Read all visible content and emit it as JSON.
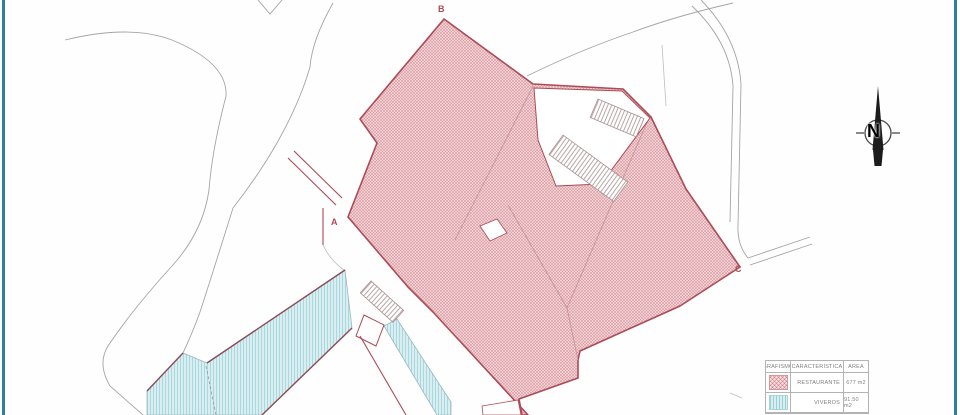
{
  "labels": {
    "point_a": "A",
    "point_b": "B",
    "point_c": "C"
  },
  "compass": {
    "north_label": "N"
  },
  "legend": {
    "headers": [
      "GRAFISMO",
      "CARACTERISTICA",
      "AREA"
    ],
    "rows": [
      {
        "swatch": "red-crosshatch",
        "caracteristica": "RESTAURANTE",
        "area": "677 m2"
      },
      {
        "swatch": "blue-stripes",
        "caracteristica": "VIVEROS",
        "area": "91.50 m2"
      }
    ]
  },
  "colors": {
    "frame": "#2e7e9e",
    "parcel_red": "#ad4a55",
    "hatch_red_bg": "#f5dde0",
    "hatch_red_line": "#d9959d",
    "subdiv_red": "#c58f96",
    "viveros_bg": "#d8eef1",
    "viveros_line": "#a6d6dc",
    "viveros_edge": "#8d4a52",
    "road": "#a5a5a5",
    "ink": "#1c1c1c",
    "legend_border": "#b3b3b3",
    "legend_text": "#808080",
    "ladder": "#a89090"
  }
}
